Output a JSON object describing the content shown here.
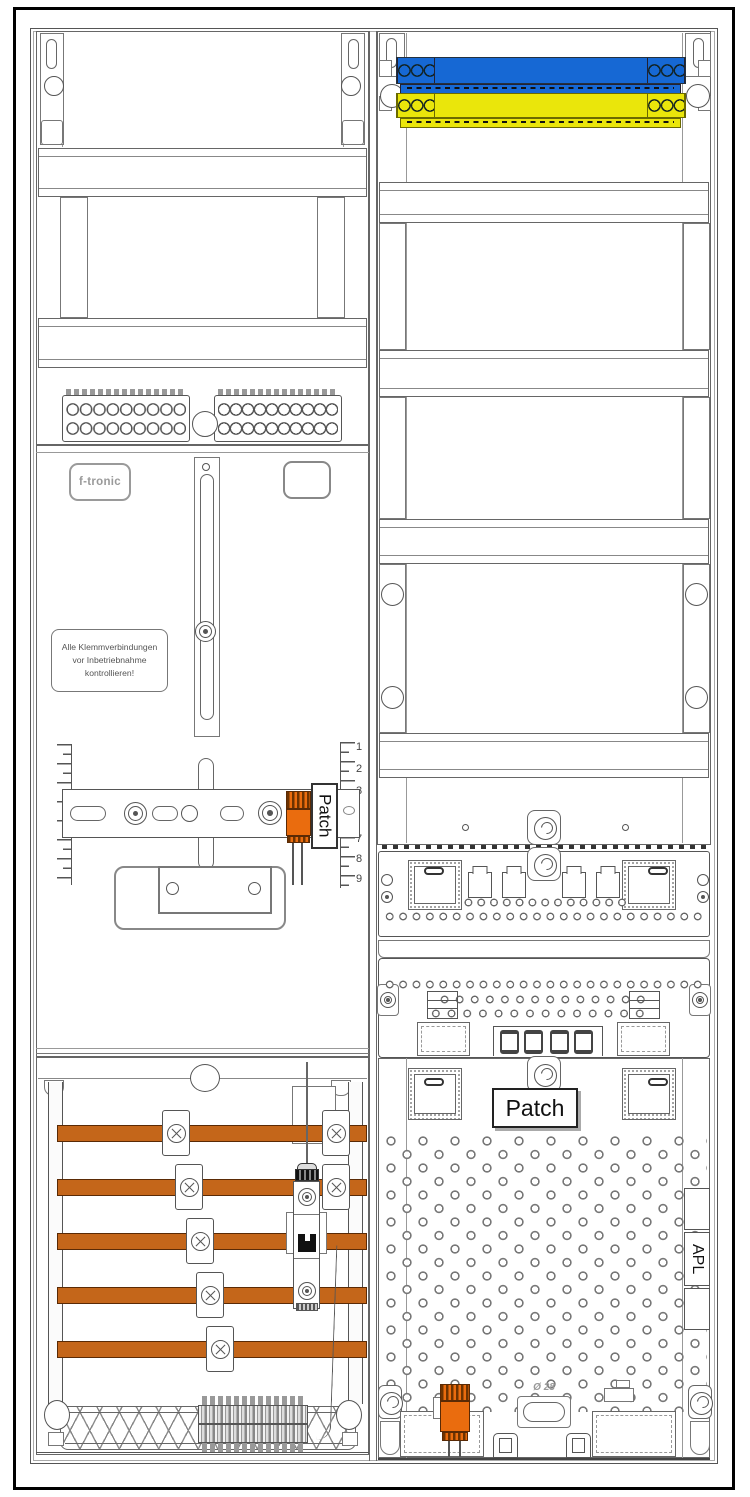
{
  "cabinet": {
    "brand_badge": "f-tronic",
    "warning": {
      "line1": "Alle Klemmverbindungen",
      "line2": "vor Inbetriebnahme",
      "line3": "kontrollieren!"
    },
    "left_patch_label": "Patch",
    "right_patch_label": "Patch",
    "apl_label": "APL",
    "diameter_label": "Ø 28",
    "ruler": {
      "top_numbers": [
        "1",
        "2",
        "3"
      ],
      "bottom_numbers": [
        "7",
        "8",
        "9"
      ]
    },
    "colors": {
      "busbar": "#c4661a",
      "device_orange": "#ea6c0e",
      "neutral_bar_blue": "#1668d4",
      "pe_bar_yellow": "#eae60b",
      "outline": "#555555"
    }
  }
}
